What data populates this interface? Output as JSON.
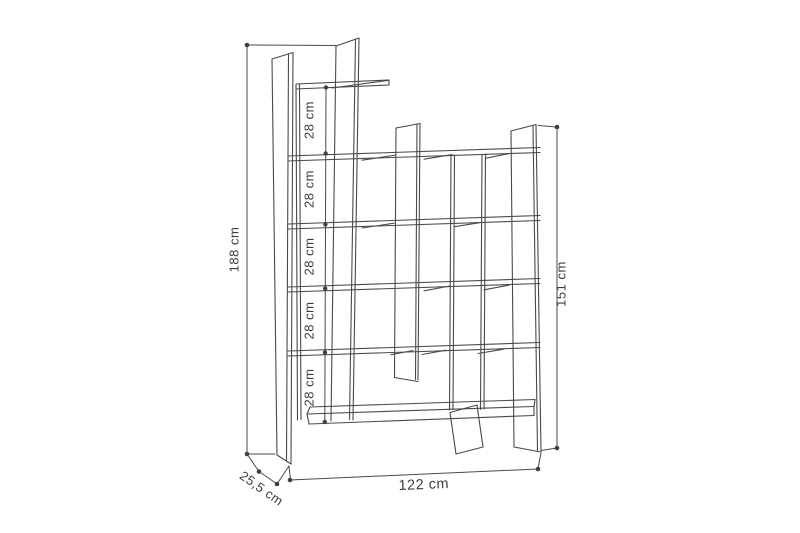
{
  "diagram": {
    "background_color": "#ffffff",
    "line_color": "#4a4a4a",
    "dimensions": {
      "total_height_label": "188 cm",
      "right_height_label": "151 cm",
      "width_label": "122 cm",
      "depth_label": "25,5 cm"
    },
    "shelf_gap_labels": [
      "28 cm",
      "28 cm",
      "28 cm",
      "28 cm",
      "28 cm"
    ]
  }
}
